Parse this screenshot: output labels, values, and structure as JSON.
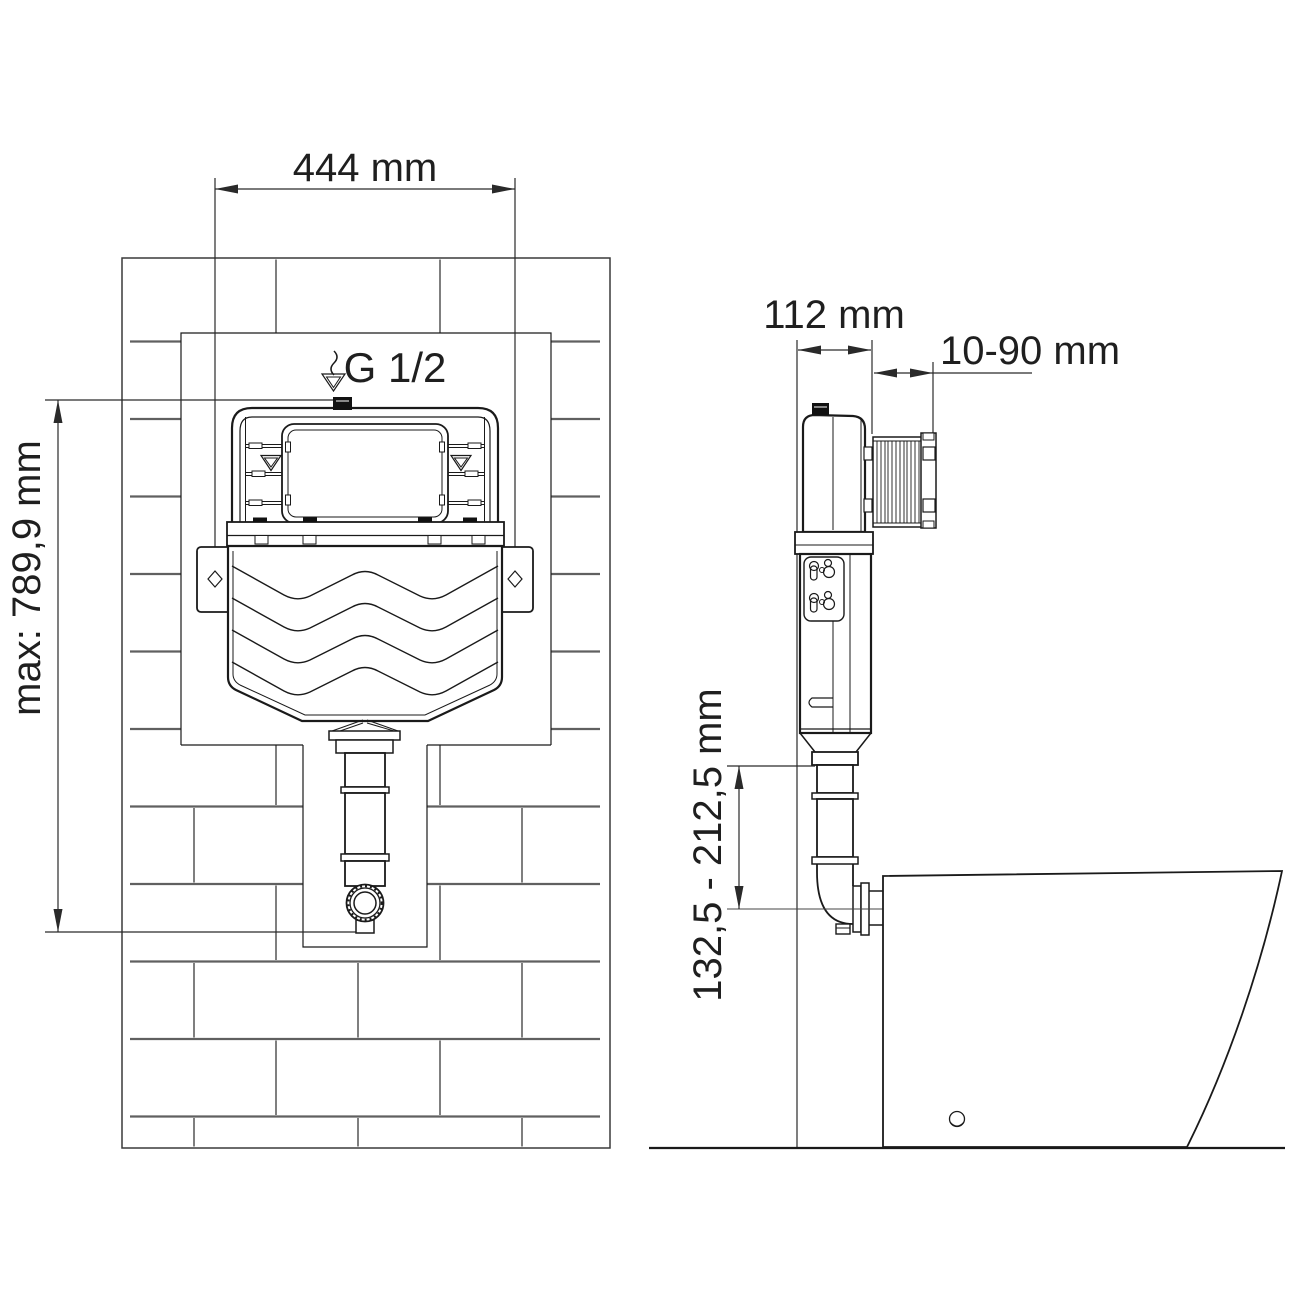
{
  "title": "Concealed cistern installation drawing",
  "front_view": {
    "dim_width": "444 mm",
    "dim_height": "max: 789,9 mm",
    "inlet_label": "G 1/2"
  },
  "side_view": {
    "dim_depth": "112 mm",
    "dim_panel_range": "10-90 mm",
    "dim_outlet_height": "132,5 - 212,5 mm"
  },
  "colors": {
    "line": "#1a1a1a",
    "dim_text": "#1f1f1f",
    "brick": "#5a5a5a",
    "background": "#ffffff"
  }
}
